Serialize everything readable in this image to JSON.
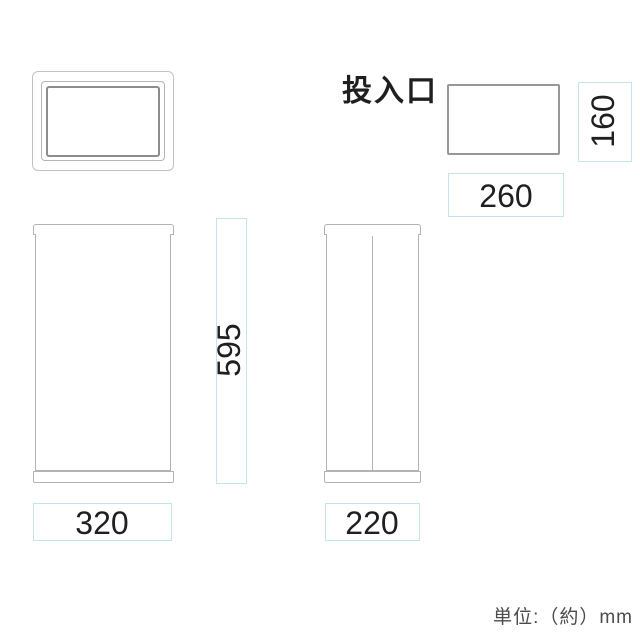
{
  "diagram": {
    "slot_label": "投入口",
    "unit_note": "単位:（約）mm",
    "dimensions": {
      "slot_width_mm": "260",
      "slot_height_mm": "160",
      "overall_height_mm": "595",
      "overall_width_mm": "320",
      "overall_depth_mm": "220"
    },
    "colors": {
      "background": "#ffffff",
      "outline_light": "#c2c2c2",
      "outline_mid": "#b3b3b3",
      "outline_dark": "#8d8d8d",
      "slot_border": "#979797",
      "dimension_box": "#c5e3ea",
      "dimension_text": "#1f1f1f",
      "note_text": "#4c4c4c"
    }
  }
}
